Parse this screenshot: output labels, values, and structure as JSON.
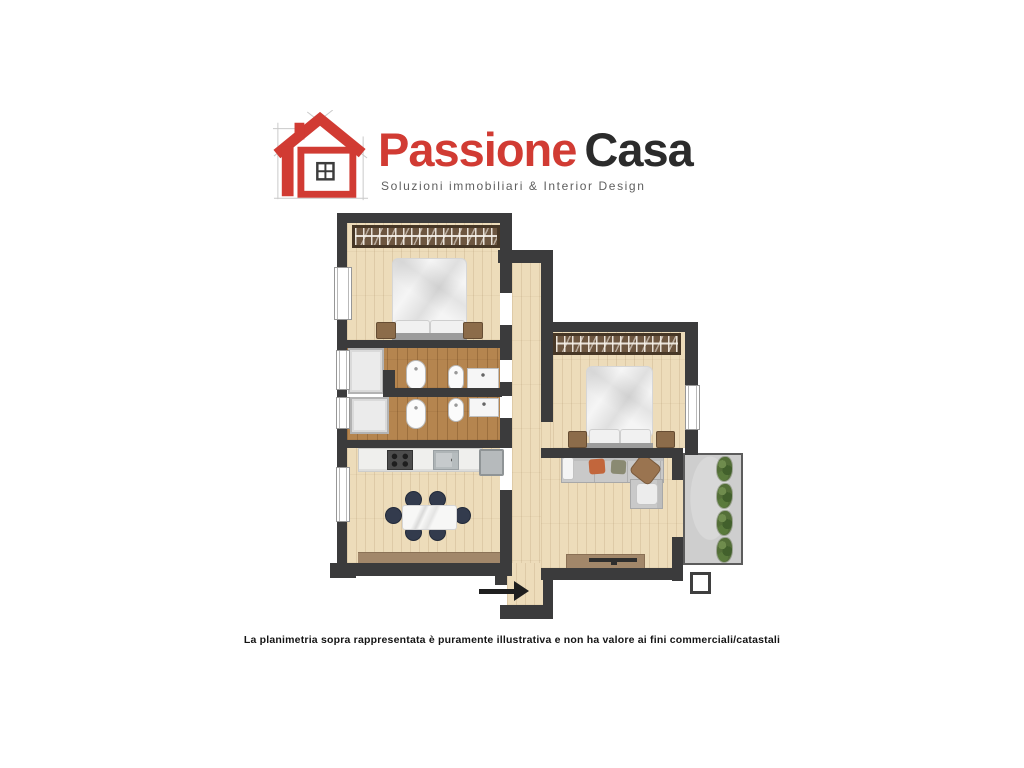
{
  "logo": {
    "icon": "house-logo-icon",
    "brand_primary": "Passione",
    "brand_secondary": "Casa",
    "tagline": "Soluzioni immobiliari & Interior Design",
    "colors": {
      "logo_red": "#d13b33",
      "logo_dark": "#2b2b2b",
      "logo_gray": "#5f5f5f"
    }
  },
  "floorplan": {
    "entry_arrow": "entry-arrow-icon",
    "colors": {
      "wall": "#3b3b3c",
      "floor_light": "#eddcba",
      "floor_bath": "#b5854f",
      "balcony_floor": "#cecece",
      "plant_green": "#546f38",
      "sofa_gray": "#c9c9c9",
      "chair_navy": "#333b4d",
      "accent_orange": "#c2663c",
      "wood_furniture": "#a2876a"
    }
  },
  "disclaimer": "La planimetria sopra rappresentata è puramente illustrativa e non ha valore ai fini commerciali/catastali"
}
